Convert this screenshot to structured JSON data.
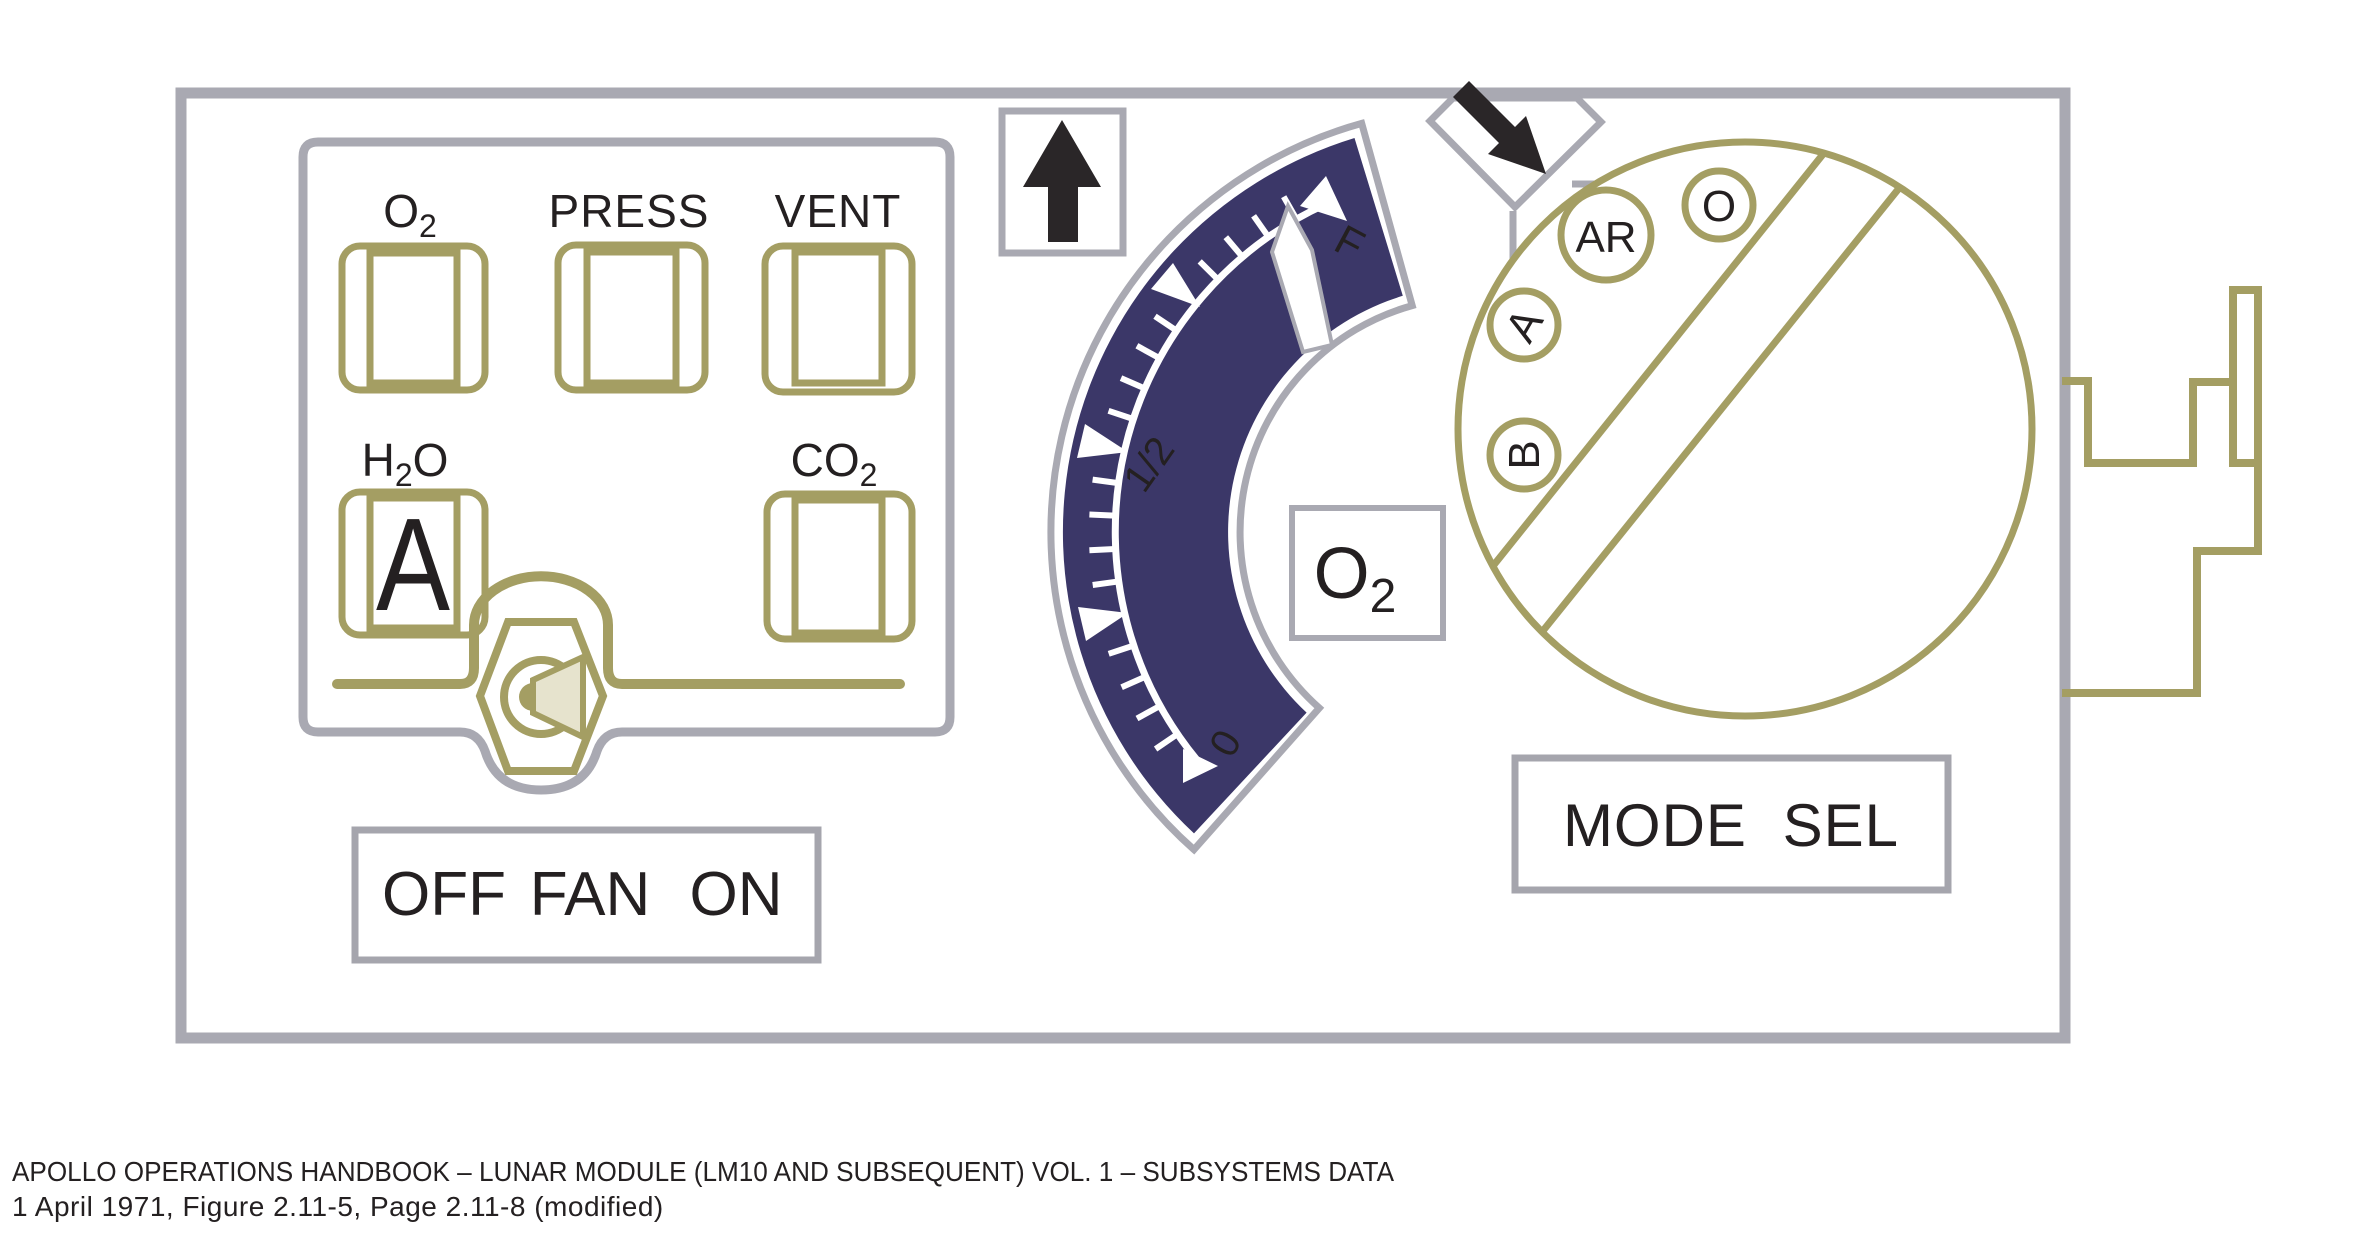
{
  "colors": {
    "olive": "#a49e63",
    "panel_gray": "#a9a9b2",
    "navy": "#3b3768",
    "ink": "#242021",
    "flag_green": "#2b7a4b",
    "speaker_beige": "#e6e3cd",
    "arrow_black": "#2a2628"
  },
  "status_panel": {
    "flags": {
      "o2": {
        "label_main": "O",
        "label_sub": "2",
        "value": ""
      },
      "press": {
        "label": "PRESS",
        "value": ""
      },
      "vent": {
        "label": "VENT",
        "value": ""
      },
      "h2o": {
        "label_pre": "H",
        "label_sub": "2",
        "label_post": "O",
        "value": "A"
      },
      "co2": {
        "label_main": "CO",
        "label_sub": "2",
        "value": ""
      }
    },
    "fan_switch": {
      "off": "OFF",
      "fan": "FAN",
      "on": "ON"
    }
  },
  "gauge": {
    "label_main": "O",
    "label_sub": "2",
    "scale": {
      "empty": "0",
      "half": "1/2",
      "full": "F"
    },
    "needle_fraction": 0.95
  },
  "mode_selector": {
    "title": "MODE SEL",
    "positions": {
      "ar": "AR",
      "o": "O",
      "a": "A",
      "b": "B"
    }
  },
  "caption": {
    "line1": "APOLLO OPERATIONS HANDBOOK – LUNAR MODULE (LM10 AND SUBSEQUENT) VOL. 1 – SUBSYSTEMS DATA",
    "line2": "1 April 1971, Figure 2.11-5, Page 2.11-8 (modified)"
  }
}
